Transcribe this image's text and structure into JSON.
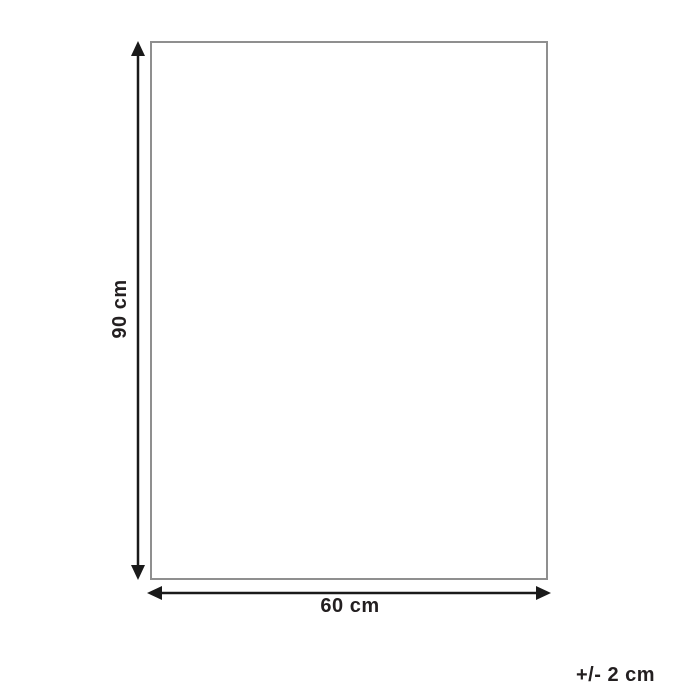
{
  "diagram": {
    "type": "product-dimension-diagram",
    "height_label": "90 cm",
    "width_label": "60 cm",
    "tolerance_label": "+/- 2 cm",
    "colors": {
      "background": "#ffffff",
      "outline": "#8f8f8f",
      "arrow": "#1a1a1a",
      "text": "#231f20"
    }
  }
}
